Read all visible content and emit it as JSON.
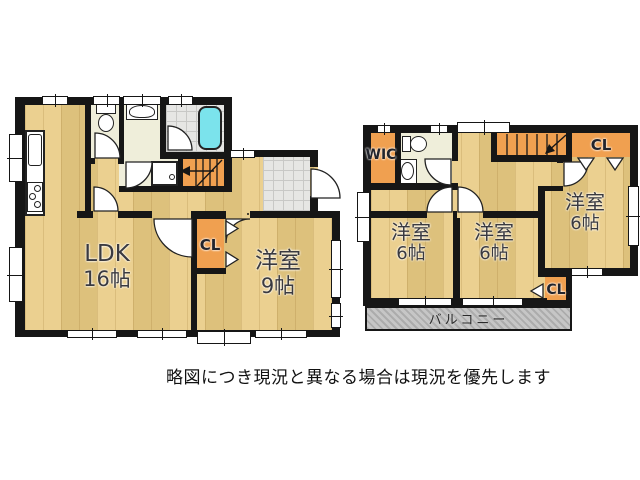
{
  "title": "間取り図",
  "note": "略図につき現況と異なる場合は現況を優先します",
  "floor1": {
    "ldk": {
      "name": "LDK",
      "size": "16帖"
    },
    "western9": {
      "name": "洋室",
      "size": "9帖"
    },
    "closet": "CL"
  },
  "floor2": {
    "western6_left": {
      "name": "洋室",
      "size": "6帖"
    },
    "western6_mid": {
      "name": "洋室",
      "size": "6帖"
    },
    "western6_right": {
      "name": "洋室",
      "size": "6帖"
    },
    "wic": "WIC",
    "closet_top": "CL",
    "closet_bottom": "CL",
    "balcony": "バルコニー"
  },
  "colors": {
    "floor_wood": "#e9cb83",
    "closet_orange": "#f0a050",
    "washroom_cream": "#efeeda",
    "tile_gray": "#e6e6e4",
    "bathtub_cyan": "#7be3ec",
    "balcony_gray": "#c6c6c6",
    "wall_black": "#161616"
  }
}
